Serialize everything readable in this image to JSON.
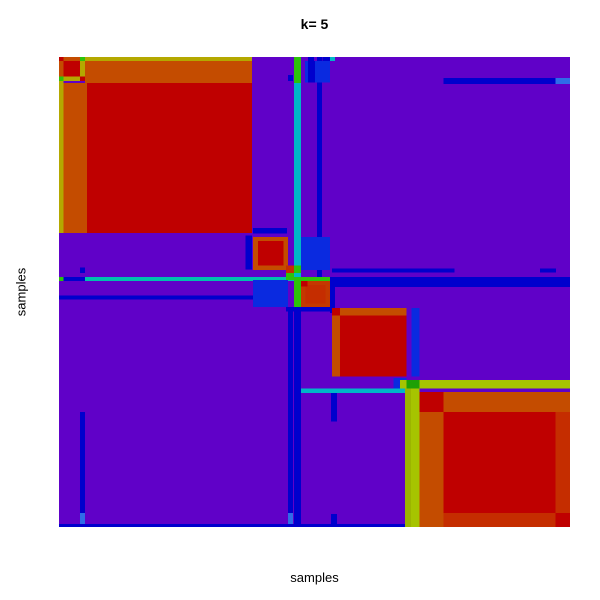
{
  "title": "k= 5",
  "axes": {
    "xlabel": "samples",
    "ylabel": "samples"
  },
  "chart_data": {
    "type": "heatmap",
    "subtype": "consensus-clustering-matrix",
    "title": "k= 5",
    "xlabel": "samples",
    "ylabel": "samples",
    "k": 5,
    "grid": false,
    "legend": "none",
    "axis_ticks": "none",
    "plot_region_px": {
      "left": 59,
      "top": 57,
      "width": 511,
      "height": 470
    },
    "colormap_low_to_high": [
      "#6001c8",
      "#0000cd",
      "#0a2ae0",
      "#00b6c8",
      "#2cc30a",
      "#a6c400",
      "#b4a800",
      "#c44c00",
      "#bf0000"
    ],
    "background_value_color": "#6001c8",
    "clusters_diagonal_fraction_ranges": [
      {
        "cluster": 1,
        "range": [
          0.0,
          0.378
        ],
        "core_color": "#bf0000",
        "border_color": "#c44c00"
      },
      {
        "cluster": 2,
        "range": [
          0.38,
          0.453
        ],
        "core_color": "#bf0000",
        "border_color": "#c44c00"
      },
      {
        "cluster": 3,
        "range": [
          0.444,
          0.532
        ],
        "core_color": "#c43800",
        "border_color": "#2cc30a"
      },
      {
        "cluster": 4,
        "range": [
          0.534,
          0.68
        ],
        "core_color": "#bf0000",
        "border_color": "#c44c00"
      },
      {
        "cluster": 5,
        "range": [
          0.705,
          1.0
        ],
        "core_color": "#bf0000",
        "border_color": "#c44c00"
      }
    ],
    "palette": {
      "P": "#6001c8",
      "N": "#0000cd",
      "B": "#0a2ae0",
      "LB": "#2f6ce8",
      "C": "#00b6c8",
      "T": "#00bfae",
      "G": "#2cc30a",
      "DG": "#1ea006",
      "YG": "#a6c400",
      "OL": "#b4a800",
      "OL2": "#9cb400",
      "O": "#c44c00",
      "RO": "#c43800",
      "R2": "#c52d00",
      "R": "#bf0000"
    },
    "rects": [
      [
        0.0,
        0.0,
        1.0,
        1.0,
        "P"
      ],
      [
        0.46,
        0.0,
        0.014,
        0.009,
        "G"
      ],
      [
        0.46,
        0.009,
        0.014,
        0.046,
        "G"
      ],
      [
        0.46,
        0.055,
        0.014,
        0.413,
        "C"
      ],
      [
        0.46,
        0.534,
        0.014,
        0.466,
        "N"
      ],
      [
        0.505,
        0.0,
        0.01,
        0.534,
        "N"
      ],
      [
        0.0,
        0.468,
        0.009,
        0.009,
        "G"
      ],
      [
        0.009,
        0.468,
        0.042,
        0.009,
        "N"
      ],
      [
        0.051,
        0.468,
        0.409,
        0.009,
        "T"
      ],
      [
        0.46,
        0.468,
        0.014,
        0.009,
        "G"
      ],
      [
        0.474,
        0.468,
        0.056,
        0.009,
        "G"
      ],
      [
        0.534,
        0.468,
        0.466,
        0.021,
        "N"
      ],
      [
        0.0,
        0.507,
        0.38,
        0.009,
        "N"
      ],
      [
        0.448,
        0.534,
        0.01,
        0.436,
        "N"
      ],
      [
        0.448,
        0.97,
        0.01,
        0.024,
        "LB"
      ],
      [
        0.534,
        0.45,
        0.24,
        0.009,
        "N"
      ],
      [
        0.941,
        0.45,
        0.032,
        0.009,
        "N"
      ],
      [
        0.532,
        0.705,
        0.012,
        0.07,
        "N"
      ],
      [
        0.532,
        0.972,
        0.012,
        0.028,
        "N"
      ],
      [
        0.0,
        0.994,
        0.705,
        0.006,
        "N"
      ],
      [
        0.448,
        0.038,
        0.01,
        0.013,
        "N"
      ],
      [
        0.041,
        0.448,
        0.01,
        0.012,
        "N"
      ],
      [
        0.0,
        0.0,
        0.009,
        0.009,
        "R"
      ],
      [
        0.009,
        0.0,
        0.032,
        0.009,
        "O"
      ],
      [
        0.041,
        0.0,
        0.01,
        0.009,
        "G"
      ],
      [
        0.051,
        0.0,
        0.327,
        0.009,
        "OL"
      ],
      [
        0.0,
        0.009,
        0.009,
        0.032,
        "O"
      ],
      [
        0.0,
        0.041,
        0.009,
        0.01,
        "G"
      ],
      [
        0.0,
        0.051,
        0.009,
        0.323,
        "OL"
      ],
      [
        0.009,
        0.009,
        0.032,
        0.032,
        "R"
      ],
      [
        0.041,
        0.009,
        0.01,
        0.032,
        "OL"
      ],
      [
        0.009,
        0.041,
        0.032,
        0.01,
        "OL"
      ],
      [
        0.041,
        0.041,
        0.01,
        0.01,
        "R"
      ],
      [
        0.051,
        0.009,
        0.327,
        0.046,
        "O"
      ],
      [
        0.009,
        0.055,
        0.046,
        0.319,
        "O"
      ],
      [
        0.055,
        0.055,
        0.323,
        0.319,
        "R"
      ],
      [
        0.365,
        0.38,
        0.013,
        0.072,
        "N"
      ],
      [
        0.38,
        0.364,
        0.066,
        0.012,
        "N"
      ],
      [
        0.38,
        0.383,
        0.068,
        0.07,
        "O"
      ],
      [
        0.389,
        0.392,
        0.05,
        0.052,
        "R"
      ],
      [
        0.474,
        0.383,
        0.056,
        0.07,
        "B"
      ],
      [
        0.38,
        0.474,
        0.068,
        0.058,
        "B"
      ],
      [
        0.444,
        0.444,
        0.016,
        0.016,
        "R2"
      ],
      [
        0.46,
        0.444,
        0.014,
        0.016,
        "G"
      ],
      [
        0.444,
        0.46,
        0.016,
        0.014,
        "G"
      ],
      [
        0.46,
        0.477,
        0.014,
        0.055,
        "G"
      ],
      [
        0.474,
        0.477,
        0.056,
        0.055,
        "RO"
      ],
      [
        0.482,
        0.485,
        0.04,
        0.039,
        "R2"
      ],
      [
        0.474,
        0.477,
        0.012,
        0.011,
        "R"
      ],
      [
        0.53,
        0.468,
        0.01,
        0.077,
        "N"
      ],
      [
        0.444,
        0.532,
        0.096,
        0.01,
        "N"
      ],
      [
        0.534,
        0.534,
        0.146,
        0.146,
        "O"
      ],
      [
        0.55,
        0.55,
        0.13,
        0.13,
        "R"
      ],
      [
        0.534,
        0.534,
        0.016,
        0.016,
        "R"
      ],
      [
        0.69,
        0.534,
        0.015,
        0.146,
        "B"
      ],
      [
        0.655,
        0.683,
        0.025,
        0.022,
        "B"
      ],
      [
        0.474,
        0.705,
        0.206,
        0.01,
        "C"
      ],
      [
        0.667,
        0.687,
        0.333,
        0.018,
        "YG"
      ],
      [
        0.677,
        0.705,
        0.012,
        0.295,
        "OL2"
      ],
      [
        0.689,
        0.705,
        0.016,
        0.295,
        "YG"
      ],
      [
        0.68,
        0.687,
        0.025,
        0.018,
        "DG"
      ],
      [
        0.705,
        0.713,
        0.047,
        0.042,
        "R"
      ],
      [
        0.752,
        0.713,
        0.248,
        0.042,
        "O"
      ],
      [
        0.705,
        0.755,
        0.047,
        0.245,
        "O"
      ],
      [
        0.752,
        0.755,
        0.22,
        0.215,
        "R"
      ],
      [
        0.972,
        0.755,
        0.028,
        0.215,
        "R2"
      ],
      [
        0.752,
        0.97,
        0.22,
        0.03,
        "R2"
      ],
      [
        0.972,
        0.97,
        0.028,
        0.03,
        "R"
      ],
      [
        0.752,
        0.045,
        0.22,
        0.012,
        "N"
      ],
      [
        0.972,
        0.045,
        0.028,
        0.012,
        "LB"
      ],
      [
        0.041,
        0.755,
        0.01,
        0.215,
        "N"
      ],
      [
        0.041,
        0.97,
        0.01,
        0.024,
        "LB"
      ],
      [
        0.481,
        0.009,
        0.049,
        0.045,
        "B"
      ],
      [
        0.487,
        0.009,
        0.014,
        0.045,
        "N"
      ],
      [
        0.487,
        0.0,
        0.012,
        0.009,
        "N"
      ],
      [
        0.516,
        0.0,
        0.014,
        0.009,
        "N"
      ],
      [
        0.53,
        0.0,
        0.01,
        0.009,
        "C"
      ]
    ]
  }
}
